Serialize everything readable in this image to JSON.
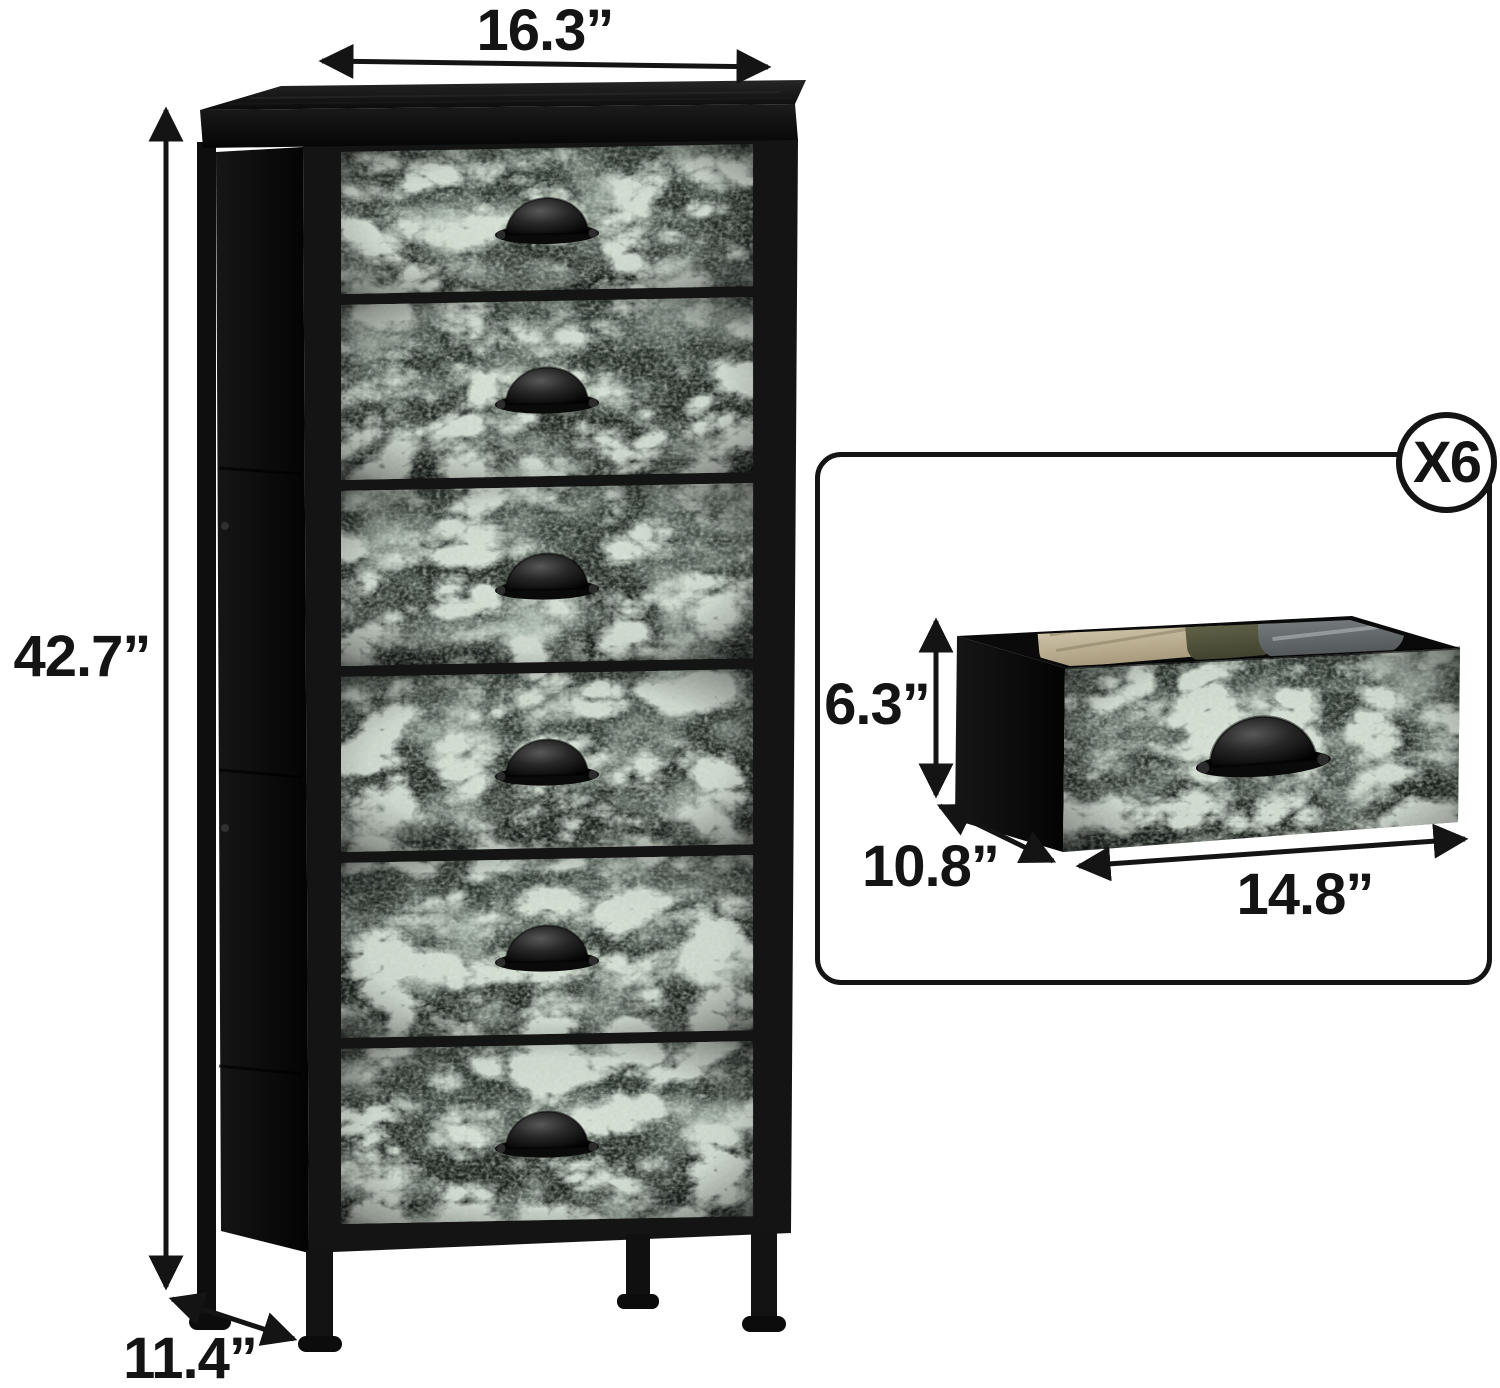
{
  "scene": {
    "background_color": "#ffffff",
    "annotation_color": "#141414"
  },
  "main_view": {
    "drawer_count": 6,
    "width_label": "16.3”",
    "height_label": "42.7”",
    "depth_label": "11.4”"
  },
  "inset_view": {
    "count_badge": "X6",
    "height_label": "6.3”",
    "depth_label": "10.8”",
    "width_label": "14.8”"
  },
  "materials": {
    "drawer_fabric_base": "#273029",
    "drawer_fabric_vein": "#aabfa8",
    "frame_color": "#121212",
    "top_board_color": "#141414"
  }
}
